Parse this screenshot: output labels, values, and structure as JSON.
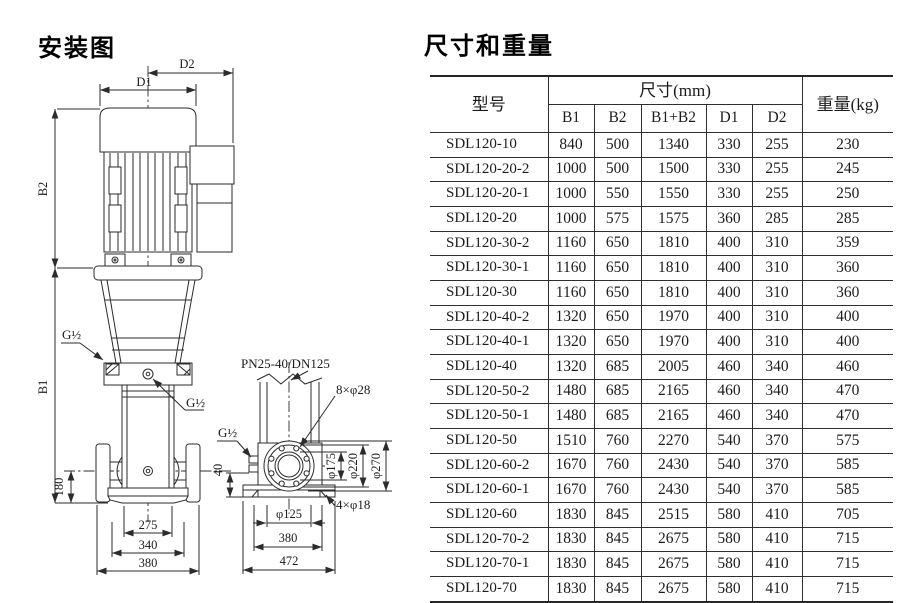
{
  "diagram": {
    "title": "安装图",
    "labels": {
      "d2": "D2",
      "d1": "D1",
      "b2": "B2",
      "b1": "B1",
      "g_vent": "G½",
      "g_port": "G½",
      "g_side": "G½",
      "dim_180": "180",
      "dim_275": "275",
      "dim_340": "340",
      "dim_380_front": "380",
      "flange_spec": "PN25-40/DN125",
      "flange_bolts": "8×φ28",
      "phi_175": "φ175",
      "phi_220": "φ220",
      "phi_270": "φ270",
      "dim_40": "40",
      "phi_125": "φ125",
      "base_bolts": "4×φ18",
      "dim_380_side": "380",
      "dim_472": "472"
    }
  },
  "table": {
    "title": "尺寸和重量",
    "header": {
      "model": "型号",
      "size_group": "尺寸(mm)",
      "weight": "重量(kg)",
      "sub_columns": [
        "B1",
        "B2",
        "B1+B2",
        "D1",
        "D2"
      ]
    },
    "rows": [
      [
        "SDL120-10",
        "840",
        "500",
        "1340",
        "330",
        "255",
        "230"
      ],
      [
        "SDL120-20-2",
        "1000",
        "500",
        "1500",
        "330",
        "255",
        "245"
      ],
      [
        "SDL120-20-1",
        "1000",
        "550",
        "1550",
        "330",
        "255",
        "250"
      ],
      [
        "SDL120-20",
        "1000",
        "575",
        "1575",
        "360",
        "285",
        "285"
      ],
      [
        "SDL120-30-2",
        "1160",
        "650",
        "1810",
        "400",
        "310",
        "359"
      ],
      [
        "SDL120-30-1",
        "1160",
        "650",
        "1810",
        "400",
        "310",
        "360"
      ],
      [
        "SDL120-30",
        "1160",
        "650",
        "1810",
        "400",
        "310",
        "360"
      ],
      [
        "SDL120-40-2",
        "1320",
        "650",
        "1970",
        "400",
        "310",
        "400"
      ],
      [
        "SDL120-40-1",
        "1320",
        "650",
        "1970",
        "400",
        "310",
        "400"
      ],
      [
        "SDL120-40",
        "1320",
        "685",
        "2005",
        "460",
        "340",
        "460"
      ],
      [
        "SDL120-50-2",
        "1480",
        "685",
        "2165",
        "460",
        "340",
        "470"
      ],
      [
        "SDL120-50-1",
        "1480",
        "685",
        "2165",
        "460",
        "340",
        "470"
      ],
      [
        "SDL120-50",
        "1510",
        "760",
        "2270",
        "540",
        "370",
        "575"
      ],
      [
        "SDL120-60-2",
        "1670",
        "760",
        "2430",
        "540",
        "370",
        "585"
      ],
      [
        "SDL120-60-1",
        "1670",
        "760",
        "2430",
        "540",
        "370",
        "585"
      ],
      [
        "SDL120-60",
        "1830",
        "845",
        "2515",
        "580",
        "410",
        "705"
      ],
      [
        "SDL120-70-2",
        "1830",
        "845",
        "2675",
        "580",
        "410",
        "715"
      ],
      [
        "SDL120-70-1",
        "1830",
        "845",
        "2675",
        "580",
        "410",
        "715"
      ],
      [
        "SDL120-70",
        "1830",
        "845",
        "2675",
        "580",
        "410",
        "715"
      ]
    ]
  }
}
